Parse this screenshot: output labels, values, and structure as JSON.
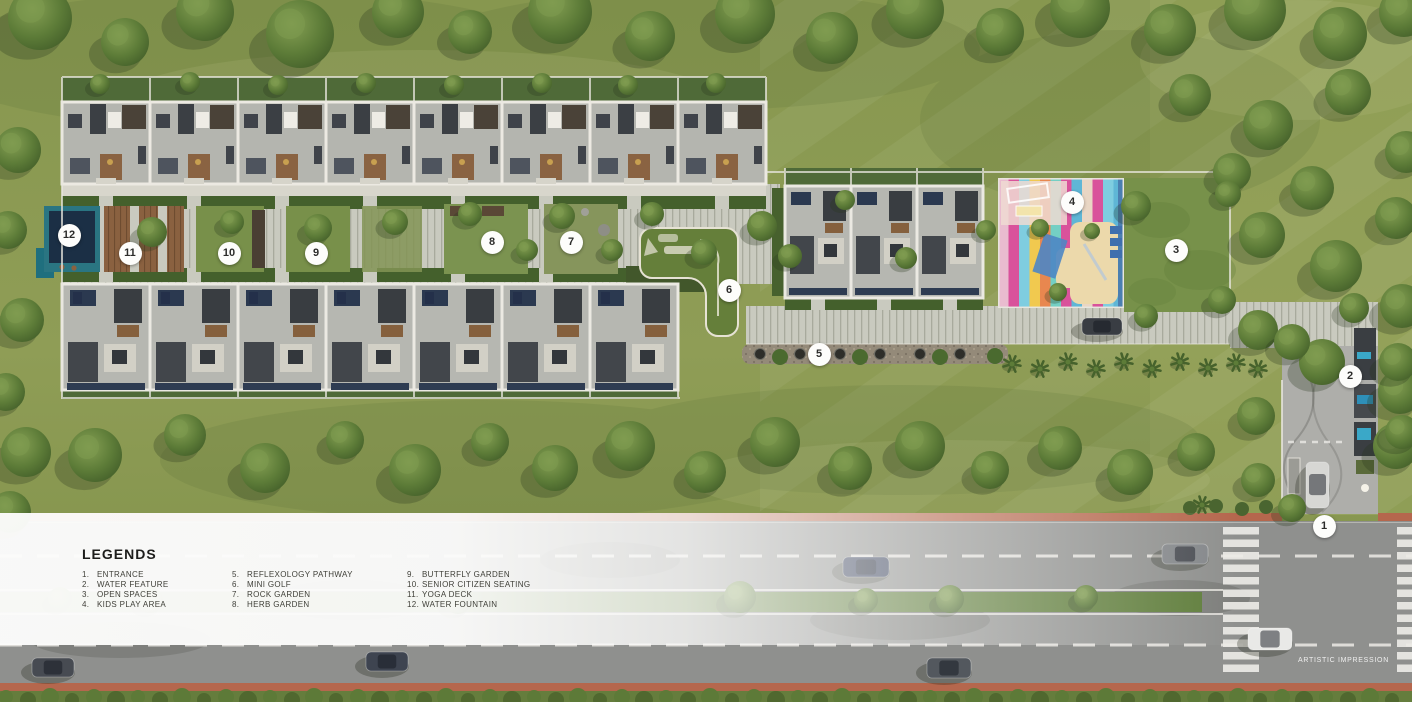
{
  "meta": {
    "artistic_impression": "ARTISTIC IMPRESSION"
  },
  "legend": {
    "title": "LEGENDS",
    "columns": [
      [
        {
          "num": "1.",
          "label": "ENTRANCE"
        },
        {
          "num": "2.",
          "label": "WATER FEATURE"
        },
        {
          "num": "3.",
          "label": "OPEN SPACES"
        },
        {
          "num": "4.",
          "label": "KIDS PLAY AREA"
        }
      ],
      [
        {
          "num": "5.",
          "label": "REFLEXOLOGY PATHWAY"
        },
        {
          "num": "6.",
          "label": "MINI GOLF"
        },
        {
          "num": "7.",
          "label": "ROCK GARDEN"
        },
        {
          "num": "8.",
          "label": "HERB GARDEN"
        }
      ],
      [
        {
          "num": "9.",
          "label": "BUTTERFLY GARDEN"
        },
        {
          "num": "10.",
          "label": "SENIOR CITIZEN SEATING"
        },
        {
          "num": "11.",
          "label": "YOGA DECK"
        },
        {
          "num": "12.",
          "label": "WATER FOUNTAIN"
        }
      ]
    ]
  },
  "map": {
    "markers": [
      {
        "number": 1,
        "name": "ENTRANCE",
        "x": 1324,
        "y": 526
      },
      {
        "number": 2,
        "name": "WATER FEATURE",
        "x": 1350,
        "y": 376
      },
      {
        "number": 3,
        "name": "OPEN SPACES",
        "x": 1176,
        "y": 250
      },
      {
        "number": 4,
        "name": "KIDS PLAY AREA",
        "x": 1072,
        "y": 202
      },
      {
        "number": 5,
        "name": "REFLEXOLOGY PATHWAY",
        "x": 819,
        "y": 354
      },
      {
        "number": 6,
        "name": "MINI GOLF",
        "x": 729,
        "y": 290
      },
      {
        "number": 7,
        "name": "ROCK GARDEN",
        "x": 571,
        "y": 242
      },
      {
        "number": 8,
        "name": "HERB GARDEN",
        "x": 492,
        "y": 242
      },
      {
        "number": 9,
        "name": "BUTTERFLY GARDEN",
        "x": 316,
        "y": 253
      },
      {
        "number": 10,
        "name": "SENIOR CITIZEN SEATING",
        "x": 229,
        "y": 253
      },
      {
        "number": 11,
        "name": "YOGA DECK",
        "x": 130,
        "y": 253
      },
      {
        "number": 12,
        "name": "WATER FOUNTAIN",
        "x": 69,
        "y": 235
      }
    ]
  },
  "colors": {
    "terracotta_kerb": "#b5674d",
    "asphalt": "#8f908e",
    "grass": "#8a9852",
    "marker_background": "#fdfdfb",
    "legend_text": "#3f3f38",
    "kids_play_pink": "#d9529b",
    "water_teal": "#2a7582"
  }
}
